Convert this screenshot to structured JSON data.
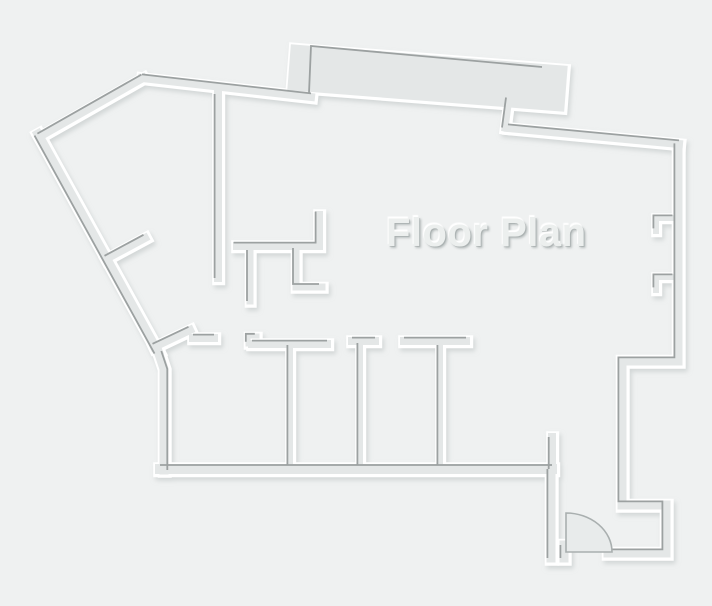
{
  "labels": {
    "title": "Floor Plan"
  },
  "colors": {
    "background": "#eff1f1",
    "wall_fill": "#e4e7e7",
    "wall_edge": "#9ca1a1",
    "wall_halo": "#ffffff",
    "door_fill": "#e8ebeb",
    "door_edge": "#a9afaf",
    "soft_shadow": "#c2c8c8"
  },
  "canvas": {
    "width": 712,
    "height": 606
  },
  "floorplan": {
    "walls": [
      {
        "name": "nw-upper-diagonal",
        "pts": [
          [
            39,
            137
          ],
          [
            143,
            78
          ]
        ],
        "w": 8,
        "dark": [
          -1.6,
          -3.4
        ]
      },
      {
        "name": "north-west-wall",
        "pts": [
          [
            142,
            78
          ],
          [
            311,
            97
          ]
        ],
        "w": 8,
        "dark": [
          0,
          -3.6
        ]
      },
      {
        "name": "north-slab",
        "pts": [
          [
            312,
            69
          ],
          [
            543,
            87
          ]
        ],
        "w": 46,
        "darkPts": [
          [
            309,
            93
          ],
          [
            311,
            46
          ],
          [
            542,
            67
          ]
        ]
      },
      {
        "name": "slab-connector",
        "pts": [
          [
            509,
            98
          ],
          [
            505,
            128
          ]
        ],
        "w": 7,
        "dark": [
          -3,
          -0.5
        ]
      },
      {
        "name": "north-east-wall",
        "pts": [
          [
            508,
            128
          ],
          [
            679,
            144
          ]
        ],
        "w": 8,
        "dark": [
          0,
          -3.6
        ]
      },
      {
        "name": "east-south-wall",
        "pts": [
          [
            678,
            147
          ],
          [
            678,
            361
          ],
          [
            622,
            361
          ],
          [
            622,
            505
          ],
          [
            666,
            505
          ],
          [
            666,
            553
          ],
          [
            608,
            553
          ]
        ],
        "w": 9,
        "dark": [
          -3.6,
          -3.6
        ]
      },
      {
        "name": "east-tab-1",
        "pts": [
          [
            656,
            231
          ],
          [
            656,
            218
          ],
          [
            675,
            218
          ]
        ],
        "w": 6,
        "dark": [
          -2.6,
          -2.6
        ]
      },
      {
        "name": "east-tab-2",
        "pts": [
          [
            656,
            290
          ],
          [
            656,
            277
          ],
          [
            675,
            277
          ]
        ],
        "w": 6,
        "dark": [
          -2.6,
          -2.6
        ]
      },
      {
        "name": "west-diagonal",
        "pts": [
          [
            38,
            134
          ],
          [
            158,
            352
          ]
        ],
        "w": 9,
        "dark": [
          -3.5,
          1.6
        ]
      },
      {
        "name": "west-lower-wall",
        "pts": [
          [
            158,
            351
          ],
          [
            164,
            369
          ],
          [
            164,
            470
          ]
        ],
        "w": 9,
        "dark": [
          3.3,
          0
        ]
      },
      {
        "name": "south-wall",
        "pts": [
          [
            160,
            469
          ],
          [
            552,
            469
          ]
        ],
        "w": 10,
        "dark": [
          0,
          -4
        ]
      },
      {
        "name": "closet-stub-upper",
        "pts": [
          [
            106,
            259
          ],
          [
            145,
            238
          ]
        ],
        "w": 8,
        "dark": [
          -1.5,
          -3.2
        ]
      },
      {
        "name": "closet-stub-lower",
        "pts": [
          [
            154,
            347
          ],
          [
            190,
            330
          ]
        ],
        "w": 8,
        "dark": [
          -1.5,
          -3.2
        ]
      },
      {
        "name": "hall-wall-vertical",
        "pts": [
          [
            218,
            94
          ],
          [
            218,
            278
          ]
        ],
        "w": 8,
        "dark": [
          -3.4,
          0
        ]
      },
      {
        "name": "kitchen-wall",
        "pts": [
          [
            319,
            215
          ],
          [
            319,
            246
          ],
          [
            237,
            246
          ]
        ],
        "w": 8,
        "dark": [
          -3.4,
          -3.4
        ]
      },
      {
        "name": "kitchen-stub-1",
        "pts": [
          [
            250,
            250
          ],
          [
            250,
            301
          ]
        ],
        "w": 7,
        "dark": [
          -3,
          0
        ]
      },
      {
        "name": "kitchen-stub-2",
        "pts": [
          [
            296,
            251
          ],
          [
            296,
            287
          ],
          [
            322,
            287
          ]
        ],
        "w": 7,
        "dark": [
          -3,
          -3
        ]
      },
      {
        "name": "rooms-top-dash",
        "pts": [
          [
            193,
            338
          ],
          [
            214,
            338
          ]
        ],
        "w": 8,
        "dark": [
          0,
          -3.4
        ]
      },
      {
        "name": "rooms-top-step",
        "pts": [
          [
            248,
            344
          ],
          [
            248,
            336
          ],
          [
            257,
            336
          ]
        ],
        "w": 5,
        "dark": [
          -2.2,
          -2.2
        ]
      },
      {
        "name": "rooms-top-wall-1",
        "pts": [
          [
            252,
            344
          ],
          [
            327,
            344
          ]
        ],
        "w": 8,
        "dark": [
          0,
          -3.4
        ]
      },
      {
        "name": "rooms-top-wall-2",
        "pts": [
          [
            352,
            341
          ],
          [
            375,
            341
          ]
        ],
        "w": 8,
        "dark": [
          0,
          -3.4
        ]
      },
      {
        "name": "rooms-top-wall-3",
        "pts": [
          [
            404,
            341
          ],
          [
            466,
            341
          ]
        ],
        "w": 8,
        "dark": [
          0,
          -3.4
        ]
      },
      {
        "name": "room-divider-1",
        "pts": [
          [
            290,
            345
          ],
          [
            290,
            465
          ]
        ],
        "w": 6,
        "dark": [
          -2.6,
          0
        ]
      },
      {
        "name": "room-divider-2",
        "pts": [
          [
            360,
            343
          ],
          [
            360,
            465
          ]
        ],
        "w": 6,
        "dark": [
          -2.6,
          0
        ]
      },
      {
        "name": "room-divider-3",
        "pts": [
          [
            440,
            345
          ],
          [
            440,
            465
          ]
        ],
        "w": 6,
        "dark": [
          -2.6,
          0
        ]
      },
      {
        "name": "entry-stub",
        "pts": [
          [
            552,
            437
          ],
          [
            552,
            469
          ]
        ],
        "w": 8,
        "dark": [
          -3.3,
          0
        ]
      },
      {
        "name": "entry-west-wall",
        "pts": [
          [
            551,
            469
          ],
          [
            551,
            558
          ]
        ],
        "w": 9,
        "dark": [
          -3.6,
          0
        ]
      },
      {
        "name": "door-jamb",
        "pts": [
          [
            564,
            545
          ],
          [
            564,
            558
          ]
        ],
        "w": 9,
        "dark": [
          -3.6,
          0
        ]
      }
    ],
    "door": {
      "hingeX": 566,
      "topY": 513,
      "footX": 612,
      "floorY": 552,
      "rx": 46,
      "ry": 39
    }
  }
}
